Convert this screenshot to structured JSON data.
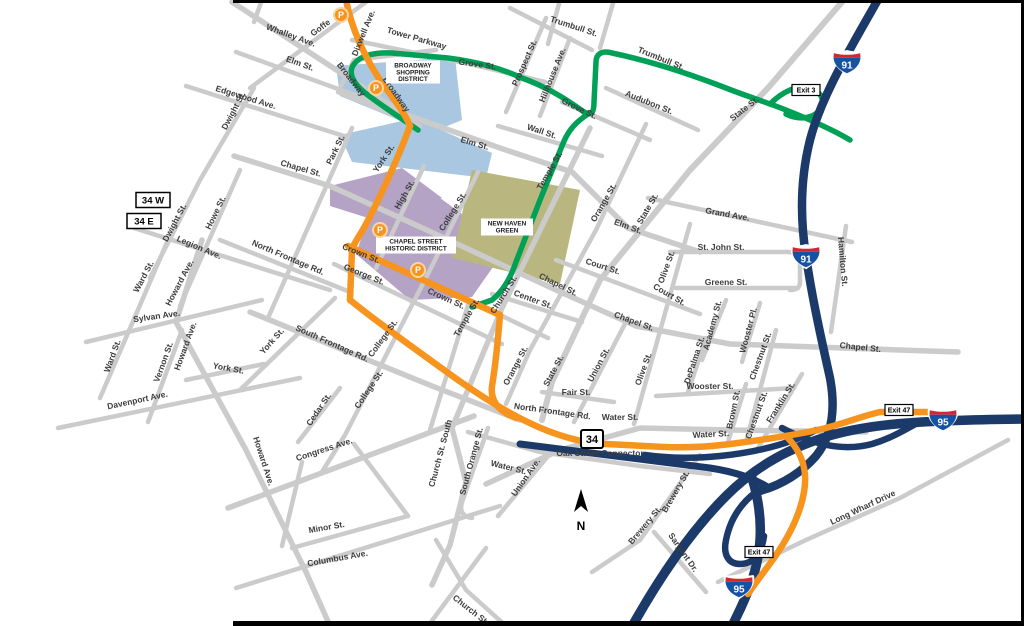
{
  "map": {
    "colors": {
      "road_gray": "#cbcbcb",
      "highway_navy": "#1c3a69",
      "route_orange": "#f7941d",
      "route_green": "#00a156",
      "district_blue": "#a9c7e1",
      "district_purple": "#b4a3c4",
      "green_space_olive": "#b9b67f",
      "label_gray": "#3d3d3d",
      "shield_blue": "#1552a4",
      "shield_red": "#d22630"
    },
    "street_labels": [
      {
        "t": "Whalley Ave.",
        "x": 290,
        "y": 38,
        "r": 20
      },
      {
        "t": "Goffe",
        "x": 322,
        "y": 30,
        "r": -37
      },
      {
        "t": "Dixwell Ave.",
        "x": 366,
        "y": 34,
        "r": -68
      },
      {
        "t": "Tower Parkway",
        "x": 416,
        "y": 41,
        "r": 16
      },
      {
        "t": "Broadway",
        "x": 349,
        "y": 81,
        "r": 52
      },
      {
        "t": "Broadway",
        "x": 394,
        "y": 96,
        "r": 55
      },
      {
        "t": "Elm St.",
        "x": 299,
        "y": 66,
        "r": 20
      },
      {
        "t": "Edgewood Ave.",
        "x": 245,
        "y": 100,
        "r": 17
      },
      {
        "t": "Dwight St.",
        "x": 236,
        "y": 112,
        "r": -62
      },
      {
        "t": "Dwight St.",
        "x": 177,
        "y": 224,
        "r": -62
      },
      {
        "t": "Park St.",
        "x": 338,
        "y": 151,
        "r": -64
      },
      {
        "t": "Howe St.",
        "x": 218,
        "y": 214,
        "r": -64
      },
      {
        "t": "York St.",
        "x": 386,
        "y": 160,
        "r": -56
      },
      {
        "t": "High St.",
        "x": 407,
        "y": 196,
        "r": -60
      },
      {
        "t": "College St.",
        "x": 455,
        "y": 213,
        "r": -58
      },
      {
        "t": "Grove St.",
        "x": 477,
        "y": 67,
        "r": 8
      },
      {
        "t": "Prospect St.",
        "x": 527,
        "y": 64,
        "r": -66
      },
      {
        "t": "Hillhouse Ave.",
        "x": 555,
        "y": 76,
        "r": -68
      },
      {
        "t": "Trumbull St.",
        "x": 573,
        "y": 29,
        "r": 18
      },
      {
        "t": "Trumbull St.",
        "x": 660,
        "y": 61,
        "r": 22
      },
      {
        "t": "Audubon St.",
        "x": 648,
        "y": 105,
        "r": 22
      },
      {
        "t": "Grove St.",
        "x": 578,
        "y": 111,
        "r": 26
      },
      {
        "t": "State St.",
        "x": 746,
        "y": 111,
        "r": -38
      },
      {
        "t": "Wall St.",
        "x": 541,
        "y": 134,
        "r": 18
      },
      {
        "t": "Elm St.",
        "x": 474,
        "y": 146,
        "r": 16
      },
      {
        "t": "Temple St.",
        "x": 552,
        "y": 172,
        "r": -60
      },
      {
        "t": "Elm St.",
        "x": 627,
        "y": 229,
        "r": 20
      },
      {
        "t": "Orange St.",
        "x": 606,
        "y": 204,
        "r": -60
      },
      {
        "t": "State St.",
        "x": 650,
        "y": 210,
        "r": -60
      },
      {
        "t": "Grand Ave.",
        "x": 727,
        "y": 217,
        "r": 10
      },
      {
        "t": "St. John St.",
        "x": 721,
        "y": 250,
        "r": 0
      },
      {
        "t": "Greene St.",
        "x": 726,
        "y": 285,
        "r": 0
      },
      {
        "t": "Court St.",
        "x": 602,
        "y": 269,
        "r": 18
      },
      {
        "t": "Court St.",
        "x": 668,
        "y": 297,
        "r": 30
      },
      {
        "t": "Olive St.",
        "x": 669,
        "y": 268,
        "r": -70
      },
      {
        "t": "Chapel St.",
        "x": 300,
        "y": 171,
        "r": 16
      },
      {
        "t": "Chapel St.",
        "x": 557,
        "y": 287,
        "r": 26
      },
      {
        "t": "Chapel St.",
        "x": 633,
        "y": 324,
        "r": 20
      },
      {
        "t": "Chapel St.",
        "x": 860,
        "y": 350,
        "r": 6
      },
      {
        "t": "Hamilton St.",
        "x": 840,
        "y": 262,
        "r": 85
      },
      {
        "t": "Academy St.",
        "x": 715,
        "y": 326,
        "r": -75
      },
      {
        "t": "Wooster Pl.",
        "x": 751,
        "y": 331,
        "r": -75
      },
      {
        "t": "DePalma St.",
        "x": 697,
        "y": 361,
        "r": -72
      },
      {
        "t": "Chestnut St.",
        "x": 763,
        "y": 357,
        "r": -70
      },
      {
        "t": "Chestnut St.",
        "x": 759,
        "y": 416,
        "r": -70
      },
      {
        "t": "Wooster St.",
        "x": 710,
        "y": 389,
        "r": 0
      },
      {
        "t": "Brown St.",
        "x": 736,
        "y": 410,
        "r": -78
      },
      {
        "t": "Franklin St.",
        "x": 783,
        "y": 404,
        "r": -58
      },
      {
        "t": "Crown St.",
        "x": 360,
        "y": 256,
        "r": 22
      },
      {
        "t": "George St.",
        "x": 363,
        "y": 277,
        "r": 22
      },
      {
        "t": "Crown St.",
        "x": 445,
        "y": 301,
        "r": 24
      },
      {
        "t": "Temple St.",
        "x": 469,
        "y": 319,
        "r": -60
      },
      {
        "t": "Church St.",
        "x": 506,
        "y": 296,
        "r": -58
      },
      {
        "t": "Center St.",
        "x": 532,
        "y": 302,
        "r": 20
      },
      {
        "t": "Orange St.",
        "x": 518,
        "y": 367,
        "r": -62
      },
      {
        "t": "State St.",
        "x": 556,
        "y": 372,
        "r": -62
      },
      {
        "t": "Union St.",
        "x": 601,
        "y": 366,
        "r": -62
      },
      {
        "t": "Olive St.",
        "x": 646,
        "y": 370,
        "r": -70
      },
      {
        "t": "Fair St.",
        "x": 576,
        "y": 395,
        "r": 0
      },
      {
        "t": "North Frontage Rd.",
        "x": 287,
        "y": 260,
        "r": 23
      },
      {
        "t": "North Frontage Rd.",
        "x": 552,
        "y": 414,
        "r": 8
      },
      {
        "t": "Water St.",
        "x": 620,
        "y": 420,
        "r": 0
      },
      {
        "t": "Water St.",
        "x": 711,
        "y": 437,
        "r": -3
      },
      {
        "t": "Water St.",
        "x": 508,
        "y": 470,
        "r": 14
      },
      {
        "t": "Oak Street Connector",
        "x": 600,
        "y": 456,
        "r": 0
      },
      {
        "t": "South Frontage Rd.",
        "x": 331,
        "y": 346,
        "r": 24
      },
      {
        "t": "College St.",
        "x": 385,
        "y": 340,
        "r": -54
      },
      {
        "t": "College St.",
        "x": 371,
        "y": 391,
        "r": -56
      },
      {
        "t": "York St.",
        "x": 274,
        "y": 343,
        "r": -48
      },
      {
        "t": "York St.",
        "x": 228,
        "y": 371,
        "r": 10
      },
      {
        "t": "Cedar St.",
        "x": 321,
        "y": 411,
        "r": -56
      },
      {
        "t": "Congress Ave.",
        "x": 325,
        "y": 452,
        "r": -18
      },
      {
        "t": "Howard Ave.",
        "x": 182,
        "y": 284,
        "r": -62
      },
      {
        "t": "Howard Ave.",
        "x": 188,
        "y": 347,
        "r": -70
      },
      {
        "t": "Howard Ave.",
        "x": 261,
        "y": 462,
        "r": 72
      },
      {
        "t": "Vernon St.",
        "x": 166,
        "y": 363,
        "r": -70
      },
      {
        "t": "Ward St.",
        "x": 146,
        "y": 278,
        "r": -62
      },
      {
        "t": "Ward St.",
        "x": 115,
        "y": 357,
        "r": -70
      },
      {
        "t": "Sylvan Ave.",
        "x": 157,
        "y": 319,
        "r": -8
      },
      {
        "t": "Davenport Ave.",
        "x": 138,
        "y": 403,
        "r": -12
      },
      {
        "t": "Minor St.",
        "x": 327,
        "y": 530,
        "r": -10
      },
      {
        "t": "Columbus Ave.",
        "x": 338,
        "y": 561,
        "r": -10
      },
      {
        "t": "Church St. South",
        "x": 443,
        "y": 454,
        "r": -75
      },
      {
        "t": "South Orange St.",
        "x": 474,
        "y": 462,
        "r": -75
      },
      {
        "t": "Union Ave.",
        "x": 528,
        "y": 479,
        "r": -55
      },
      {
        "t": "Church St.",
        "x": 469,
        "y": 612,
        "r": 38
      },
      {
        "t": "Brewery St.",
        "x": 678,
        "y": 493,
        "r": -60
      },
      {
        "t": "Brewery St.",
        "x": 647,
        "y": 527,
        "r": -50
      },
      {
        "t": "Sargent Dr.",
        "x": 681,
        "y": 554,
        "r": 55
      },
      {
        "t": "Long Wharf Drive",
        "x": 864,
        "y": 510,
        "r": -25
      },
      {
        "t": "Legion Ave.",
        "x": 198,
        "y": 250,
        "r": 23
      }
    ],
    "district_labels": [
      {
        "lines": [
          "BROADWAY",
          "SHOPPING",
          "DISTRICT"
        ],
        "x": 413,
        "y": 72,
        "w": 54,
        "h": 23
      },
      {
        "lines": [
          "CHAPEL STREET",
          "HISTORIC DISTRICT"
        ],
        "x": 416,
        "y": 245,
        "w": 80,
        "h": 17
      },
      {
        "lines": [
          "NEW HAVEN",
          "GREEN"
        ],
        "x": 507,
        "y": 227,
        "w": 52,
        "h": 17
      }
    ],
    "interstate_shields": [
      {
        "num": "91",
        "x": 847,
        "y": 62
      },
      {
        "num": "91",
        "x": 806,
        "y": 256
      },
      {
        "num": "95",
        "x": 943,
        "y": 419
      },
      {
        "num": "95",
        "x": 739,
        "y": 586
      }
    ],
    "route_shields": [
      {
        "t": "34",
        "x": 592,
        "y": 439
      }
    ],
    "route_banners": [
      {
        "t": "34 W",
        "x": 153,
        "y": 200
      },
      {
        "t": "34 E",
        "x": 144,
        "y": 221
      }
    ],
    "exit_labels": [
      {
        "t": "Exit 3",
        "x": 806,
        "y": 90
      },
      {
        "t": "Exit 47",
        "x": 899,
        "y": 410
      },
      {
        "t": "Exit 47",
        "x": 759,
        "y": 552
      }
    ],
    "parking_letter": "P",
    "parking_icons": [
      {
        "x": 341,
        "y": 15
      },
      {
        "x": 376,
        "y": 88
      },
      {
        "x": 380,
        "y": 230
      },
      {
        "x": 418,
        "y": 270
      }
    ],
    "north_arrow": {
      "label": "N",
      "x": 581,
      "y": 503
    }
  }
}
